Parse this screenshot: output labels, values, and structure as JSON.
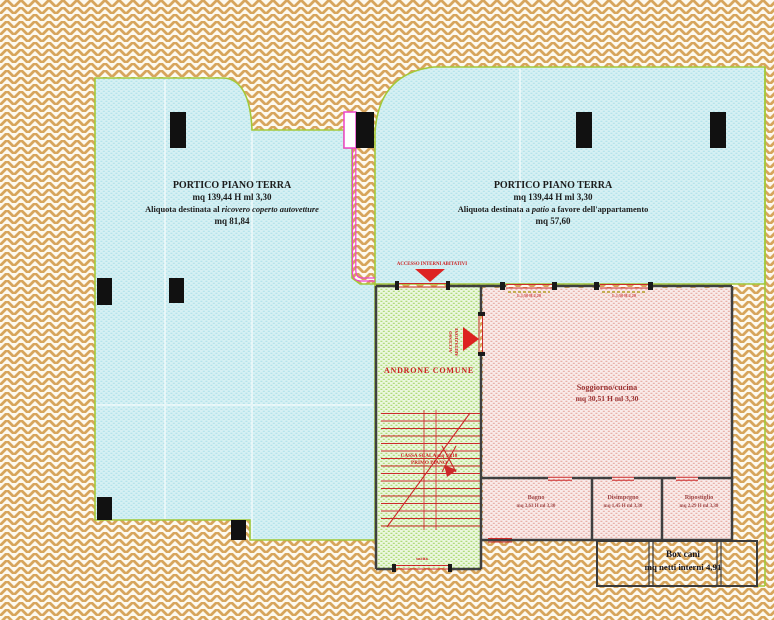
{
  "plan": {
    "portico_left": {
      "title": "PORTICO PIANO TERRA",
      "area": "mq 139,44 H ml 3,30",
      "aliquota_prefix": "Aliquota destinata al ",
      "aliquota_italic": "ricovero coperto autovetture",
      "aliquota_area": "mq 81,84"
    },
    "portico_right": {
      "title": "PORTICO PIANO TERRA",
      "area": "mq 139,44 H ml 3,30",
      "aliquota_prefix": "Aliquota destinata a ",
      "aliquota_italic": "patio",
      "aliquota_suffix": " a favore dell'appartamento",
      "aliquota_area": "mq 57,60"
    },
    "androne": {
      "label": "ANDRONE COMUNE",
      "access_top_label": "ACCESSO INTERNI ABITATIVI",
      "access_side_label_1": "ACCESSO",
      "access_side_label_2": "ABITAZIONE",
      "stair_label_1": "CASSA SCALA mq 10,18",
      "stair_label_2": "PRIMO PIANO",
      "exit_label": "uscita"
    },
    "soggiorno": {
      "name": "Soggiorno/cucina",
      "dims": "mq 30,51 H ml 3,30",
      "window1_label": "L.1,50 H.2,20",
      "window2_label": "L.1,50 H.2,20"
    },
    "rooms": {
      "bagno": {
        "name": "Bagno",
        "dims": "mq 3,63 H ml 3,30"
      },
      "disimpegno": {
        "name": "Disimpegno",
        "dims": "mq 1,45 H ml 3,30"
      },
      "ripostiglio": {
        "name": "Ripostiglio",
        "dims": "mq 2,29 H ml 3,30"
      }
    },
    "box_cani": {
      "name": "Box cani",
      "dims": "mq netti interni 4,91"
    }
  },
  "colors": {
    "background_brick": "#d7a55c",
    "portico_fill": "#d6f0f3",
    "plan_border_green": "#a3c838",
    "androne_fill": "#ebf7de",
    "soggiorno_fill": "#f9ebe9",
    "annotation_red": "#cc2222",
    "wall_dark": "#3f3f3f",
    "pillar_black": "#111111",
    "magenta_line": "#ee44cc",
    "room_label_red": "#9a3333"
  }
}
